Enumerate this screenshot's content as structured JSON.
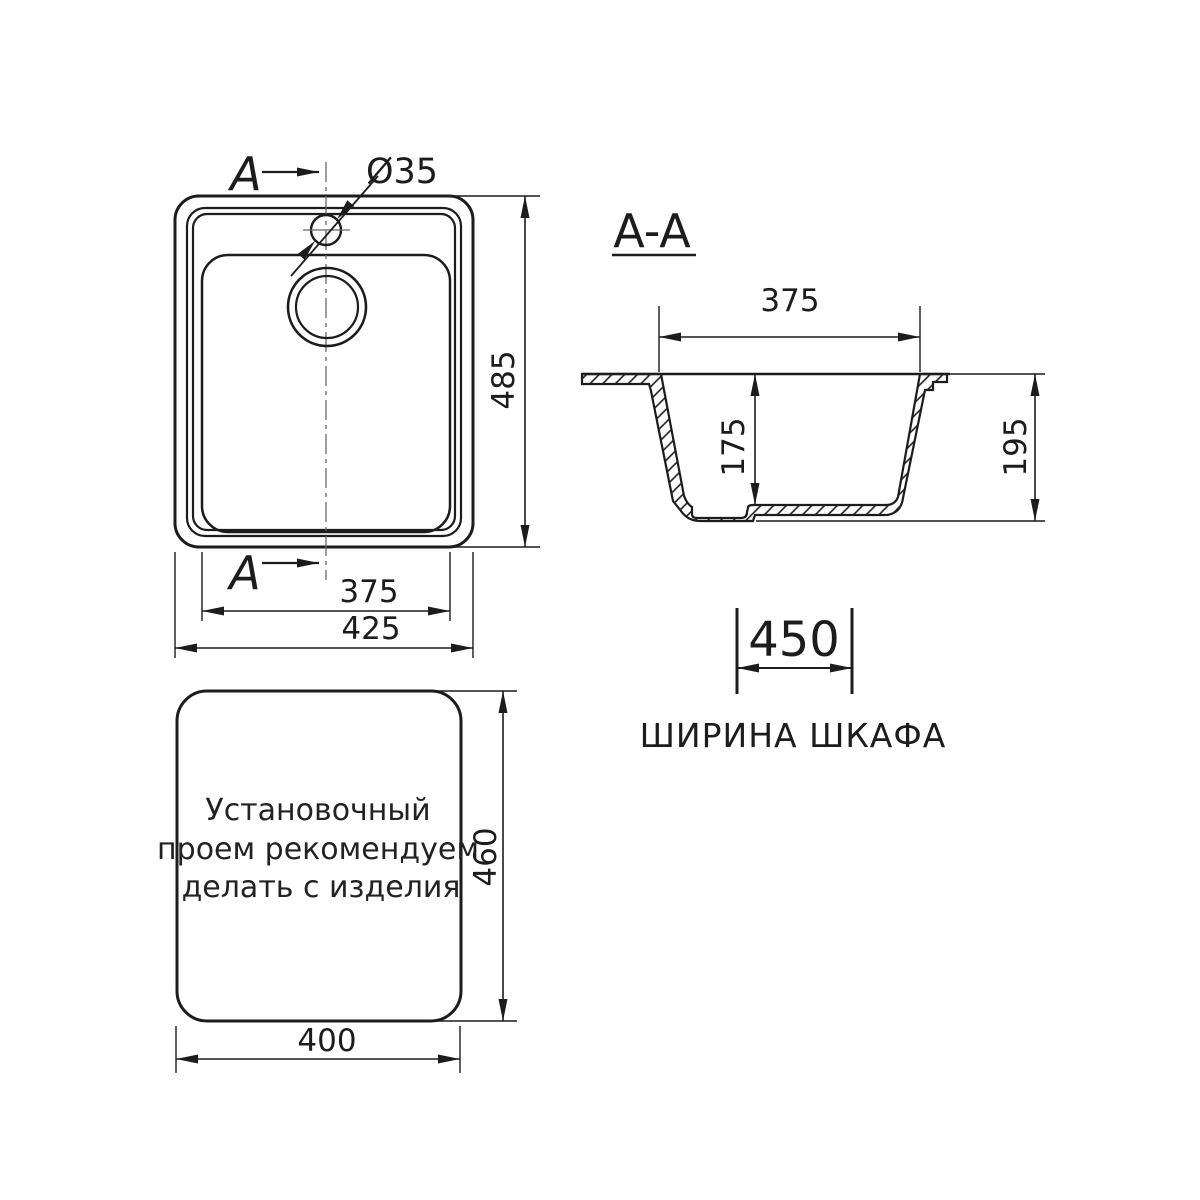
{
  "colors": {
    "line": "#1c1c1c",
    "background": "#ffffff"
  },
  "plan_view": {
    "section_label_top": "A",
    "section_label_bottom": "A",
    "faucet_hole_diameter": "Ø35",
    "dim_bowl_width": "375",
    "dim_overall_width": "425",
    "dim_overall_depth": "485"
  },
  "section_view": {
    "title": "A-A",
    "dim_bowl_top_width": "375",
    "dim_bowl_depth": "175",
    "dim_overall_height": "195"
  },
  "cabinet_dimension": {
    "dim_width": "450",
    "label": "ШИРИНА ШКАФА"
  },
  "cutout_view": {
    "note_lines": [
      "Установочный",
      "проем рекомендуем",
      "делать с изделия"
    ],
    "dim_width": "400",
    "dim_height": "460"
  }
}
